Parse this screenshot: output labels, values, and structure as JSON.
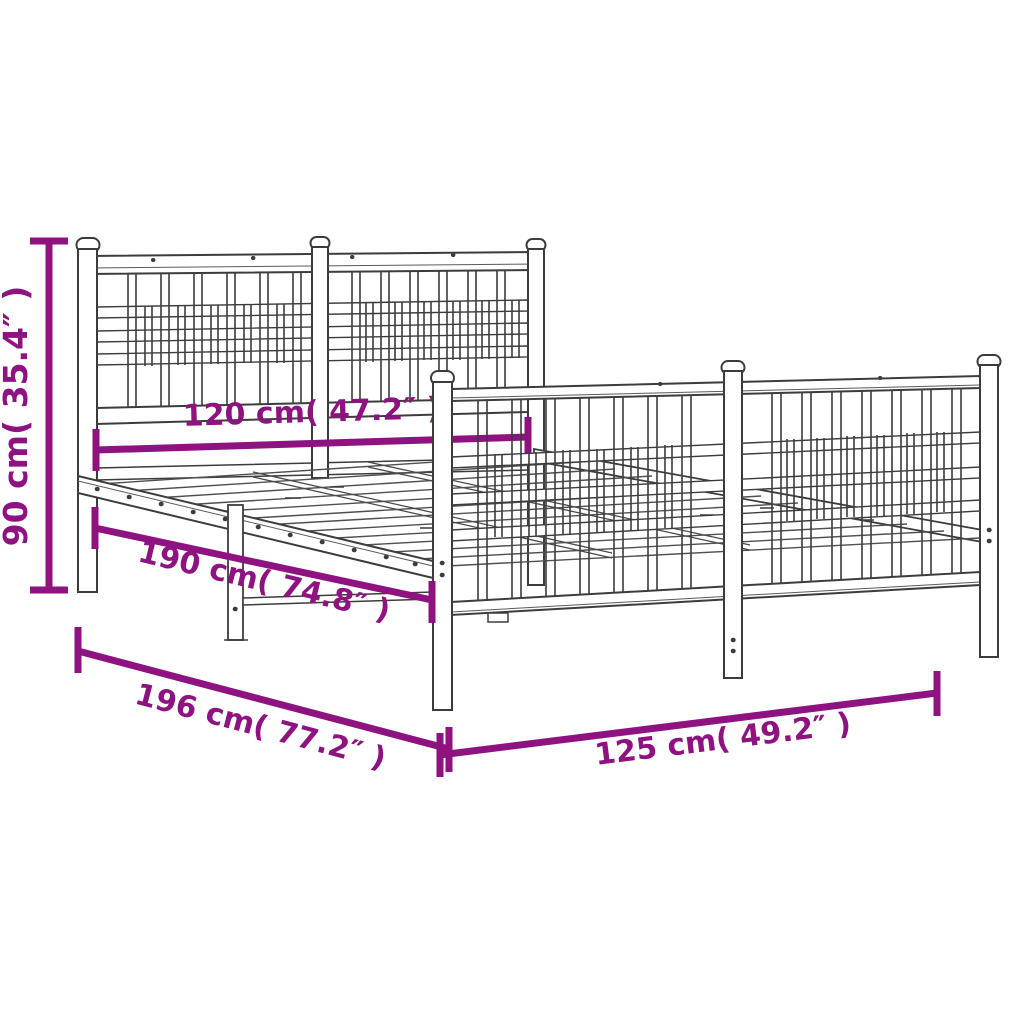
{
  "figure": {
    "kind": "product dimension line drawing",
    "subject": "metal bed frame with headboard, footboard and slatted base"
  },
  "colors": {
    "dimension_accent": "#8E1280",
    "line_art": "#3C3C3C",
    "background": "#FFFFFF"
  },
  "dimensions": {
    "height": {
      "label": "90 cm( 35.4″ )",
      "value_cm": 90,
      "value_inch": 35.4
    },
    "headboard_width": {
      "label": "120 cm( 47.2″ )",
      "value_cm": 120,
      "value_inch": 47.2
    },
    "mattress_length": {
      "label": "190 cm( 74.8″ )",
      "value_cm": 190,
      "value_inch": 74.8
    },
    "total_length": {
      "label": "196 cm( 77.2″ )",
      "value_cm": 196,
      "value_inch": 77.2
    },
    "total_width": {
      "label": "125 cm( 49.2″ )",
      "value_cm": 125,
      "value_inch": 49.2
    }
  }
}
